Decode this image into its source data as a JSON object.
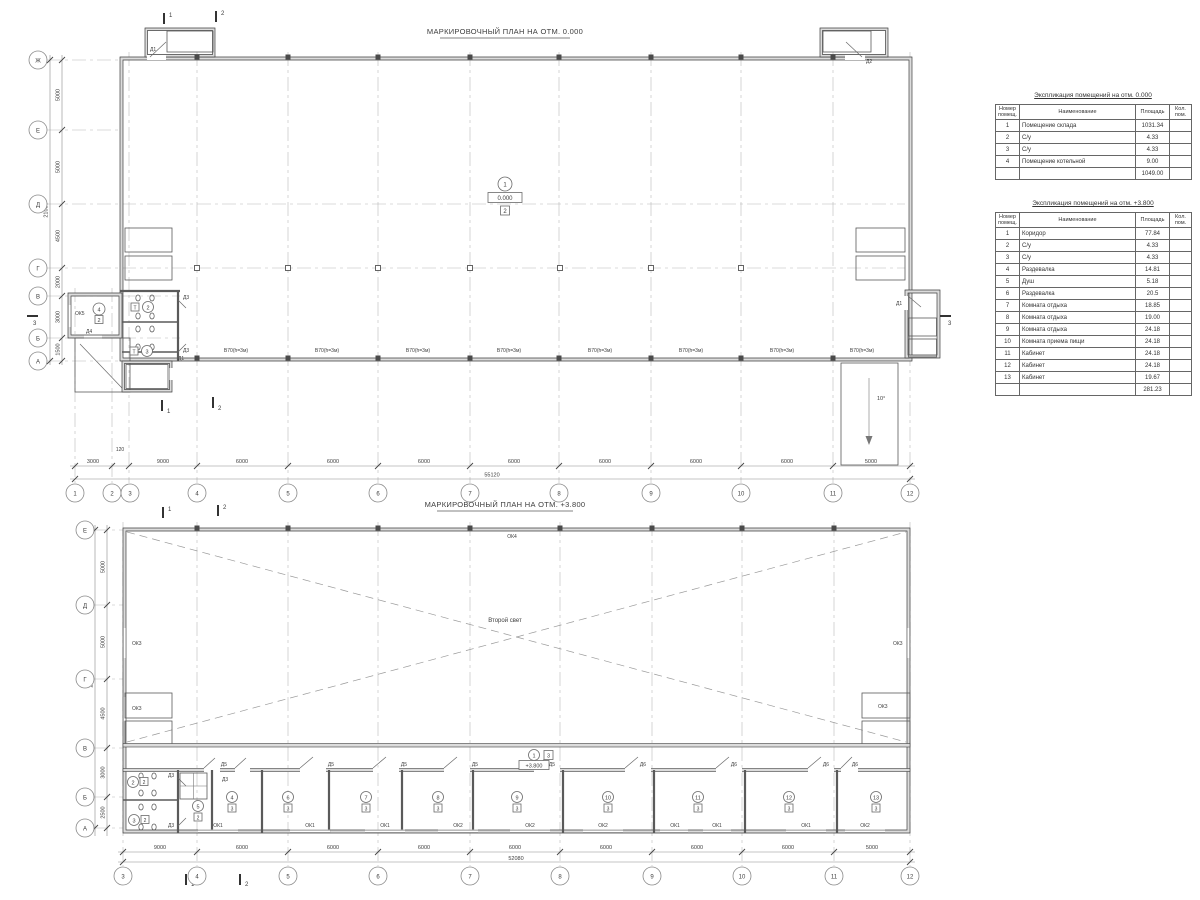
{
  "plan1": {
    "title": "МАРКИРОВОЧНЫЙ ПЛАН НА ОТМ. 0.000",
    "cols": [
      "1",
      "2",
      "3",
      "4",
      "5",
      "6",
      "7",
      "8",
      "9",
      "10",
      "11",
      "12"
    ],
    "rows": [
      "Ж",
      "Е",
      "Д",
      "Г",
      "В",
      "Б",
      "А"
    ],
    "dims": [
      "3000",
      "120",
      "9000",
      "6000",
      "6000",
      "6000",
      "6000",
      "6000",
      "6000",
      "6000",
      "5000"
    ],
    "total_w": "55120",
    "dims_left": [
      "5000",
      "5000",
      "4500",
      "2000",
      "3000",
      "1500"
    ],
    "total_h": "21000",
    "hall": {
      "num": "1",
      "elev": "0.000",
      "type": "2"
    },
    "room2": {
      "num": "2",
      "type": "Т"
    },
    "room3": {
      "num": "3",
      "type": "Т"
    },
    "room4": {
      "num": "4",
      "type": "2"
    },
    "d1": "Д1",
    "d2": "Д2",
    "d3": "Д3",
    "d4": "Д4",
    "ok5": "ОК5",
    "gate": "В70(h=3м)",
    "ramp": "10°",
    "s1": "1",
    "s2": "2",
    "s3": "3"
  },
  "plan2": {
    "title": "МАРКИРОВОЧНЫЙ ПЛАН НА ОТМ. +3.800",
    "cols": [
      "3",
      "4",
      "5",
      "6",
      "7",
      "8",
      "9",
      "10",
      "11",
      "12"
    ],
    "rows": [
      "Е",
      "Д",
      "Г",
      "В",
      "Б",
      "А"
    ],
    "dims": [
      "9000",
      "6000",
      "6000",
      "6000",
      "6000",
      "6000",
      "6000",
      "6000",
      "5000"
    ],
    "total_w": "52080",
    "dims_left": [
      "5000",
      "5000",
      "4500",
      "3000",
      "2500"
    ],
    "total_h": "20000",
    "second_light": "Второй свет",
    "corridor": {
      "num": "1",
      "type": "3",
      "elev": "+3.800"
    },
    "room2": {
      "num": "2",
      "type": "2"
    },
    "room3": {
      "num": "3",
      "type": "2"
    },
    "room4": {
      "num": "4",
      "type": "3"
    },
    "room5": {
      "num": "5",
      "type": "2"
    },
    "band": [
      {
        "num": "6",
        "type": "3"
      },
      {
        "num": "7",
        "type": "3"
      },
      {
        "num": "8",
        "type": "3"
      },
      {
        "num": "9",
        "type": "3"
      },
      {
        "num": "10",
        "type": "3"
      },
      {
        "num": "11",
        "type": "3"
      },
      {
        "num": "12",
        "type": "3"
      },
      {
        "num": "13",
        "type": "3"
      }
    ],
    "win_bottom": [
      "ОК1",
      "ОК1",
      "ОК1",
      "ОК2",
      "ОК2",
      "ОК2",
      "ОК1",
      "ОК1",
      "ОК1",
      "ОК2"
    ],
    "ok3": "ОК3",
    "ok4": "ОК4",
    "d3": "Д3",
    "d5": "Д5",
    "d6": "Д6",
    "s1": "1",
    "s2": "2"
  },
  "tables": [
    {
      "title": "Экспликация помещений на отм. 0.000",
      "headers": [
        "Номер помещ.",
        "Наименование",
        "Площадь",
        "Кол. пом."
      ],
      "rows": [
        [
          "1",
          "Помещение склада",
          "1031.34"
        ],
        [
          "2",
          "С/у",
          "4.33"
        ],
        [
          "3",
          "С/у",
          "4.33"
        ],
        [
          "4",
          "Помещение котельной",
          "9.00"
        ]
      ],
      "total": "1049.00"
    },
    {
      "title": "Экспликация помещений на отм. +3.800",
      "headers": [
        "Номер помещ.",
        "Наименование",
        "Площадь",
        "Кол. пом."
      ],
      "rows": [
        [
          "1",
          "Коридор",
          "77.84"
        ],
        [
          "2",
          "С/у",
          "4.33"
        ],
        [
          "3",
          "С/у",
          "4.33"
        ],
        [
          "4",
          "Раздевалка",
          "14.81"
        ],
        [
          "5",
          "Душ",
          "5.18"
        ],
        [
          "6",
          "Раздевалка",
          "20.5"
        ],
        [
          "7",
          "Комната отдыха",
          "18.85"
        ],
        [
          "8",
          "Комната отдыха",
          "19.00"
        ],
        [
          "9",
          "Комната отдыха",
          "24.18"
        ],
        [
          "10",
          "Комната приема пищи",
          "24.18"
        ],
        [
          "11",
          "Кабинет",
          "24.18"
        ],
        [
          "12",
          "Кабинет",
          "24.18"
        ],
        [
          "13",
          "Кабинет",
          "19.67"
        ]
      ],
      "total": "281.23"
    }
  ]
}
